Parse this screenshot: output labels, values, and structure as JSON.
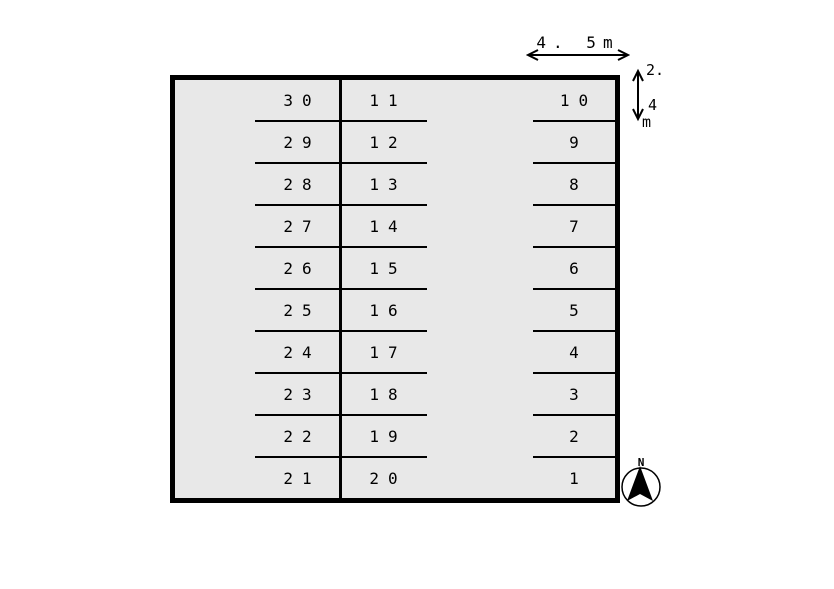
{
  "diagram": {
    "type": "parking-lot-site-plan",
    "background_color": "#ffffff",
    "lot_fill_color": "#e8e8e8",
    "line_color": "#000000"
  },
  "dimensions": {
    "width_label": "4. 5m",
    "height_label_lines": [
      "2.",
      "4",
      "m"
    ]
  },
  "compass": {
    "north_label": "N"
  },
  "parking": {
    "columns": [
      {
        "name": "left",
        "stalls": [
          "30",
          "29",
          "28",
          "27",
          "26",
          "25",
          "24",
          "23",
          "22",
          "21"
        ]
      },
      {
        "name": "middle",
        "stalls": [
          "11",
          "12",
          "13",
          "14",
          "15",
          "16",
          "17",
          "18",
          "19",
          "20"
        ]
      },
      {
        "name": "right",
        "stalls": [
          "10",
          "9",
          "8",
          "7",
          "6",
          "5",
          "4",
          "3",
          "2",
          "1"
        ]
      }
    ]
  }
}
